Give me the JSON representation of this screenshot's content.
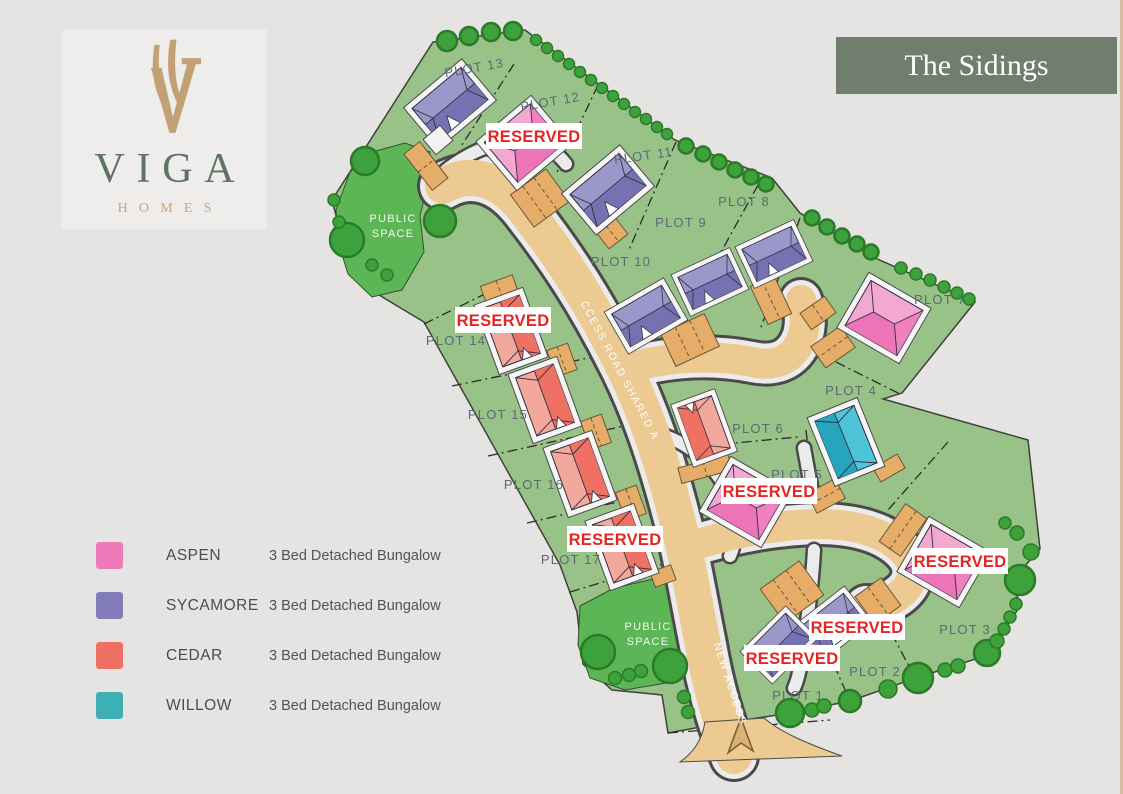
{
  "header": {
    "banner_title": "The Sidings",
    "banner_color": "#6f7e6d",
    "brand_name": "VIGA",
    "brand_sub": "HOMES",
    "brand_gold": "#c2a274",
    "brand_green": "#5e7366"
  },
  "legend": {
    "items": [
      {
        "name": "ASPEN",
        "color": "#ef7ab9",
        "description": "3 Bed Detached Bungalow"
      },
      {
        "name": "SYCAMORE",
        "color": "#837cbb",
        "description": "3 Bed Detached Bungalow"
      },
      {
        "name": "CEDAR",
        "color": "#ee7164",
        "description": "3 Bed Detached Bungalow"
      },
      {
        "name": "WILLOW",
        "color": "#3fafb6",
        "description": "3 Bed Detached Bungalow"
      }
    ]
  },
  "map": {
    "reserved_text": "RESERVED",
    "public_space": {
      "line1": "PUBLIC",
      "line2": "SPACE"
    },
    "road_labels": {
      "main": "CCESS ROAD SHARED A",
      "access": "NEW ACCESS"
    },
    "plots": [
      {
        "label": "PLOT 1",
        "house_type": "SYCAMORE",
        "reserved": true
      },
      {
        "label": "PLOT 2",
        "house_type": "SYCAMORE",
        "reserved": true
      },
      {
        "label": "PLOT 3",
        "house_type": "ASPEN",
        "reserved": true
      },
      {
        "label": "PLOT 4",
        "house_type": "WILLOW",
        "reserved": false
      },
      {
        "label": "PLOT 5",
        "house_type": "ASPEN",
        "reserved": true
      },
      {
        "label": "PLOT 6",
        "house_type": "CEDAR",
        "reserved": false
      },
      {
        "label": "PLOT 7",
        "house_type": "ASPEN",
        "reserved": false
      },
      {
        "label": "PLOT 8",
        "house_type": "SYCAMORE",
        "reserved": false
      },
      {
        "label": "PLOT 9",
        "house_type": "SYCAMORE",
        "reserved": false
      },
      {
        "label": "PLOT 10",
        "house_type": "SYCAMORE",
        "reserved": false
      },
      {
        "label": "PLOT 11",
        "house_type": "SYCAMORE",
        "reserved": false
      },
      {
        "label": "PLOT 12",
        "house_type": "ASPEN",
        "reserved": true
      },
      {
        "label": "PLOT 13",
        "house_type": "SYCAMORE",
        "reserved": false
      },
      {
        "label": "PLOT 14",
        "house_type": "CEDAR",
        "reserved": true
      },
      {
        "label": "PLOT 15",
        "house_type": "CEDAR",
        "reserved": false
      },
      {
        "label": "PLOT 16",
        "house_type": "CEDAR",
        "reserved": false
      },
      {
        "label": "PLOT 17",
        "house_type": "CEDAR",
        "reserved": true
      }
    ],
    "house_colors": {
      "aspen": {
        "light": "#f2a8d0",
        "dark": "#ee74b8"
      },
      "sycamore": {
        "light": "#9b97cb",
        "dark": "#7672b2"
      },
      "cedar": {
        "light": "#f2a89b",
        "dark": "#ee7163"
      },
      "willow": {
        "light": "#4fc4d8",
        "dark": "#28a5be"
      }
    },
    "ground_colors": {
      "site": "#98c287",
      "public_space": "#5db655",
      "road": "#ecca92"
    }
  }
}
